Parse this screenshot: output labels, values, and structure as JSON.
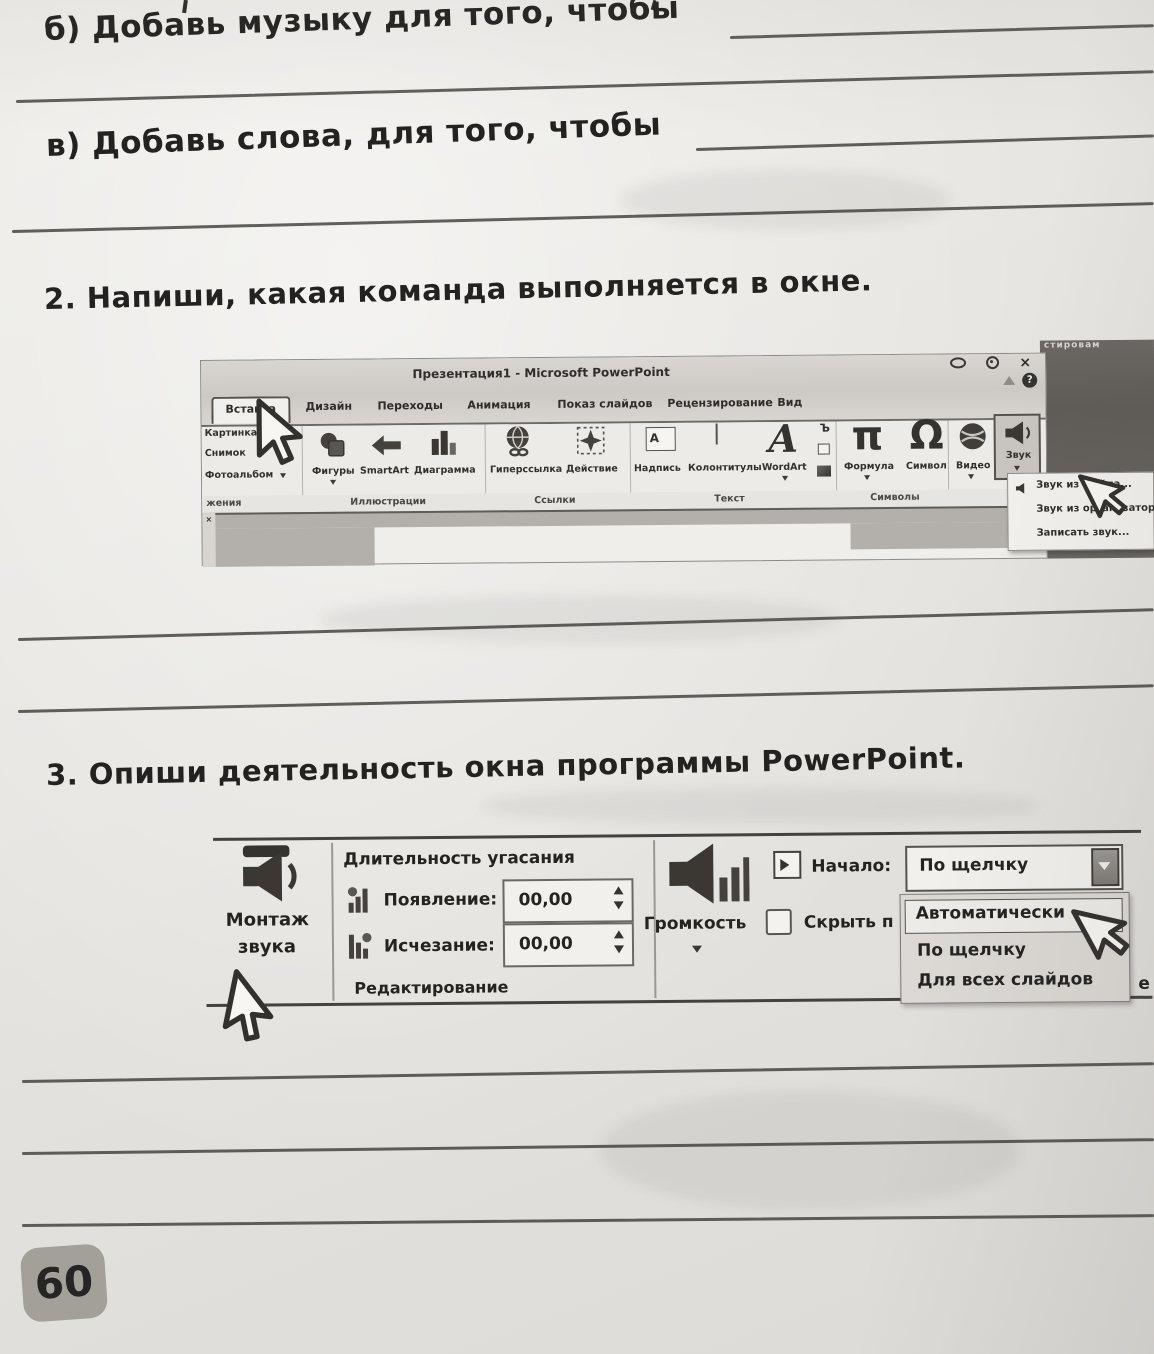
{
  "page": {
    "item_b": "б) Добавь музыку для того, чтобы",
    "item_v": "в) Добавь слова, для того, чтобы",
    "task2": "2. Напиши, какая команда выполняется в окне.",
    "task3": "3. Опиши деятельность окна программы PowerPoint.",
    "page_number": "60"
  },
  "powerpoint": {
    "corner_text": "стировам",
    "window_title": "Презентация1 - Microsoft PowerPoint",
    "help_glyph": "?",
    "close_glyph": "×",
    "tabs": [
      {
        "label": "Вставка",
        "active": true
      },
      {
        "label": "Дизайн"
      },
      {
        "label": "Переходы"
      },
      {
        "label": "Анимация"
      },
      {
        "label": "Показ слайдов"
      },
      {
        "label": "Рецензирование"
      },
      {
        "label": "Вид"
      }
    ],
    "left_column": [
      "Картинка",
      "Снимок",
      "Фотоальбом"
    ],
    "left_group_label": "жения",
    "illustrations": {
      "label": "Иллюстрации",
      "items": [
        "Фигуры",
        "SmartArt",
        "Диаграмма"
      ]
    },
    "links": {
      "label": "Ссылки",
      "items": [
        "Гиперссылка",
        "Действие"
      ]
    },
    "text_group": {
      "label": "Текст",
      "items": [
        "Надпись",
        "Колонтитулы",
        "WordArt"
      ]
    },
    "symbols": {
      "label": "Символы",
      "items": [
        "Формула",
        "Символ"
      ]
    },
    "glyphs": {
      "formula": "π",
      "symbol": "Ω",
      "wordart": "А",
      "textbox": "А",
      "date": "Ъ"
    },
    "video_label": "Видео",
    "audio_label": "Звук",
    "sound_menu": [
      "Звук из файла...",
      "Звук из организатора...",
      "Записать звук..."
    ]
  },
  "audio_tools": {
    "montage_line1": "Монтаж",
    "montage_line2": "звука",
    "fade_header": "Длительность угасания",
    "fade_in_label": "Появление:",
    "fade_in_value": "00,00",
    "fade_out_label": "Исчезание:",
    "fade_out_value": "00,00",
    "group_label": "Редактирование",
    "volume_label": "Громкость",
    "start_label": "Начало:",
    "start_value": "По щелчку",
    "hide_label": "Скрыть п",
    "menu": [
      "Автоматически",
      "По щелчку",
      "Для всех слайдов"
    ],
    "edge_fragment": "е"
  }
}
